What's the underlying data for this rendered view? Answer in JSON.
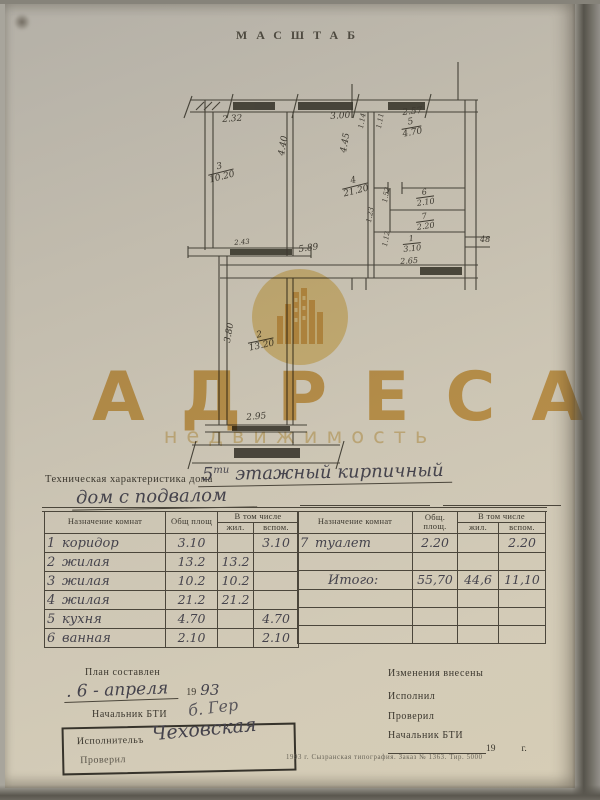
{
  "masthead": "МАСШТАБ",
  "watermark": {
    "brand": "АДРЕСА",
    "subtitle": "недвижимость",
    "gold": "#dcab51",
    "circle_fill": "#f0d694"
  },
  "plan": {
    "rooms": [
      {
        "n": "3",
        "a": "10.20",
        "x": 34,
        "y": 106,
        "r": -14
      },
      {
        "n": "4",
        "a": "21.20",
        "x": 168,
        "y": 120,
        "r": -14
      },
      {
        "n": "5",
        "a": "4.70",
        "x": 228,
        "y": 60,
        "r": -10
      },
      {
        "n": "6",
        "a": "2.10",
        "x": 243,
        "y": 130,
        "r": -8,
        "s": 8
      },
      {
        "n": "7",
        "a": "2.20",
        "x": 243,
        "y": 154,
        "r": -8,
        "s": 8
      },
      {
        "n": "1",
        "a": "3.10",
        "x": 230,
        "y": 176,
        "r": -6,
        "s": 8
      },
      {
        "n": "2",
        "a": "13.20",
        "x": 74,
        "y": 274,
        "r": -12
      }
    ],
    "dims": [
      {
        "v": "2.32",
        "x": 50,
        "y": 56,
        "r": -4
      },
      {
        "v": "3.00",
        "x": 158,
        "y": 53,
        "r": -4
      },
      {
        "v": "2.57",
        "x": 230,
        "y": 49,
        "r": -6
      },
      {
        "v": "4.40",
        "x": 106,
        "y": 95,
        "r": -80
      },
      {
        "v": "4.45",
        "x": 168,
        "y": 92,
        "r": -80
      },
      {
        "v": "1.14",
        "x": 186,
        "y": 68,
        "r": -80,
        "s": 7
      },
      {
        "v": "1.11",
        "x": 204,
        "y": 68,
        "r": -80,
        "s": 7
      },
      {
        "v": "1.52",
        "x": 210,
        "y": 142,
        "r": -80,
        "s": 7
      },
      {
        "v": "1.23",
        "x": 194,
        "y": 162,
        "r": -80,
        "s": 7
      },
      {
        "v": "1.12",
        "x": 210,
        "y": 186,
        "r": -80,
        "s": 7
      },
      {
        "v": "2.43",
        "x": 62,
        "y": 180,
        "r": -5,
        "s": 7
      },
      {
        "v": "5.89",
        "x": 126,
        "y": 186,
        "r": -8
      },
      {
        "v": "2.65",
        "x": 228,
        "y": 198,
        "r": -4,
        "s": 8
      },
      {
        "v": "48",
        "x": 308,
        "y": 176,
        "r": 0,
        "s": 8
      },
      {
        "v": "2.95",
        "x": 74,
        "y": 354,
        "r": -5
      },
      {
        "v": "3.80",
        "x": 52,
        "y": 282,
        "r": -80
      }
    ]
  },
  "tech": {
    "label": "Техническая характеристика дома",
    "hand1_num": "5",
    "hand1_sup": "ти",
    "hand1_rest": " этажный  кирпичный",
    "hand2": "дом  с  подвалом"
  },
  "table": {
    "h_name": "Назначение комнат",
    "h_total": "Общ площ",
    "h_incl": "В том числе",
    "h_liv": "жил.",
    "h_aux": "вспом.",
    "h_total2a": "Общ.",
    "h_total2b": "площ.",
    "left_rows": [
      [
        "1",
        "коридор",
        "3.10",
        "",
        "3.10"
      ],
      [
        "2",
        "жилая",
        "13.2",
        "13.2",
        ""
      ],
      [
        "3",
        "жилая",
        "10.2",
        "10.2",
        ""
      ],
      [
        "4",
        "жилая",
        "21.2",
        "21.2",
        ""
      ],
      [
        "5",
        "кухня",
        "4.70",
        "",
        "4.70"
      ],
      [
        "6",
        "ванная",
        "2.10",
        "",
        "2.10"
      ]
    ],
    "right_rows": [
      [
        "7",
        "туалет",
        "2.20",
        "",
        "2.20"
      ],
      [
        "",
        "",
        "",
        "",
        ""
      ],
      [
        "",
        "Итого:",
        "55,70",
        "44,6",
        "11,10"
      ],
      [
        "",
        "",
        "",
        "",
        ""
      ],
      [
        "",
        "",
        "",
        "",
        ""
      ],
      [
        "",
        "",
        "",
        "",
        ""
      ]
    ]
  },
  "footer": {
    "plan_made": "План составлен",
    "date_hand": ". 6 - апреля",
    "date_year_printed": "19",
    "date_year_hand": "93",
    "chief": "Начальник БТИ",
    "chief_sig": "б. Гер",
    "executor": "Исполнительъ",
    "executor_sig": "Чеховская",
    "checked": "Проверил",
    "changes": "Изменения  внесены",
    "done": "Исполнил",
    "checked2": "Проверил",
    "chief2": "Начальник БТИ",
    "year_printed": "19",
    "year_suffix": "г.",
    "imprint": "1993 г.   Сызранская типография.   Заказ № 1363.   Тир. 5000"
  }
}
